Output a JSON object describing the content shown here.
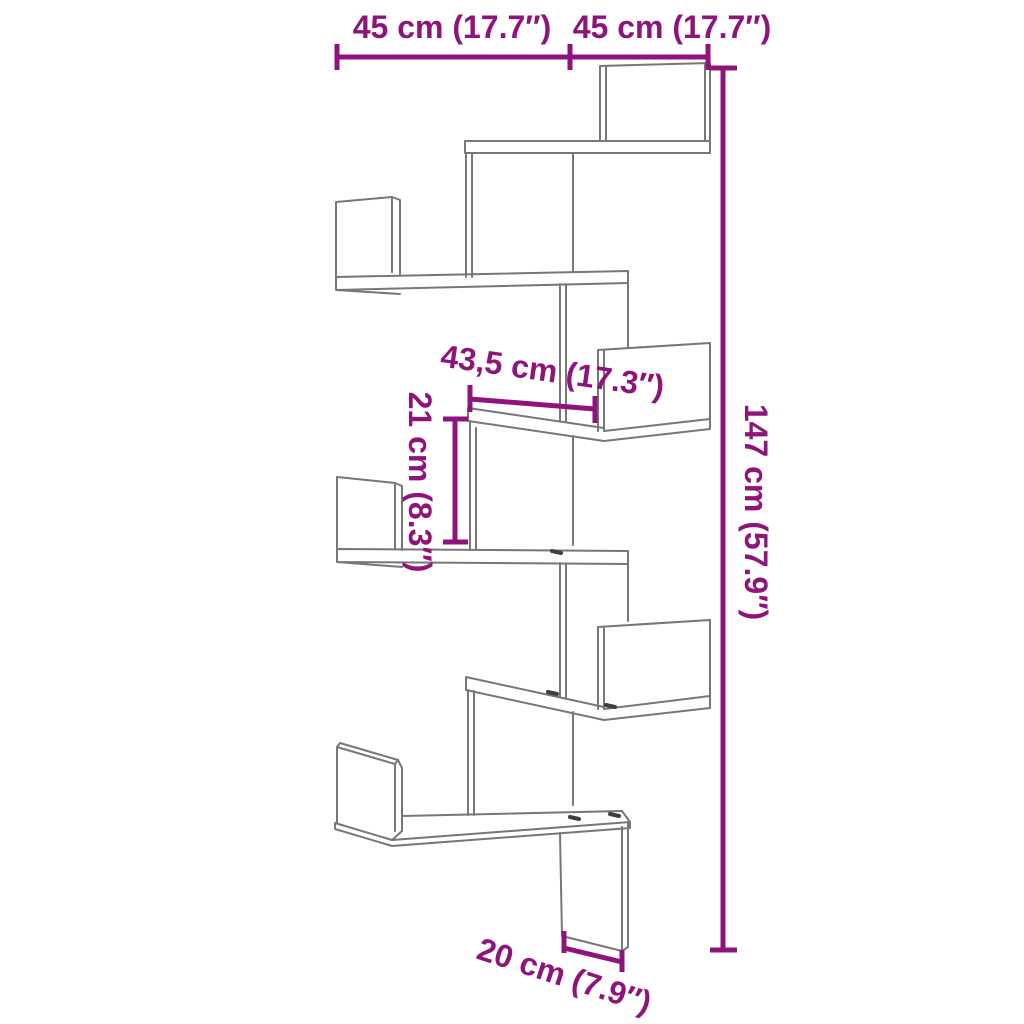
{
  "diagram": {
    "kind": "product-dimension-drawing",
    "subject": "corner wall shelf with zigzag tiers"
  },
  "colors": {
    "accent": "#8E147C",
    "line": "#777777",
    "mark": "#3F3F3F",
    "background": "#FFFFFF"
  },
  "dimensions": {
    "top_left_width": "45 cm (17.7″)",
    "top_right_width": "45 cm (17.7″)",
    "middle_shelf_width": "43,5 cm (17.3″)",
    "shelf_spacing_height": "21 cm (8.3″)",
    "total_height": "147 cm (57.9″)",
    "bottom_depth": "20 cm (7.9″)"
  }
}
